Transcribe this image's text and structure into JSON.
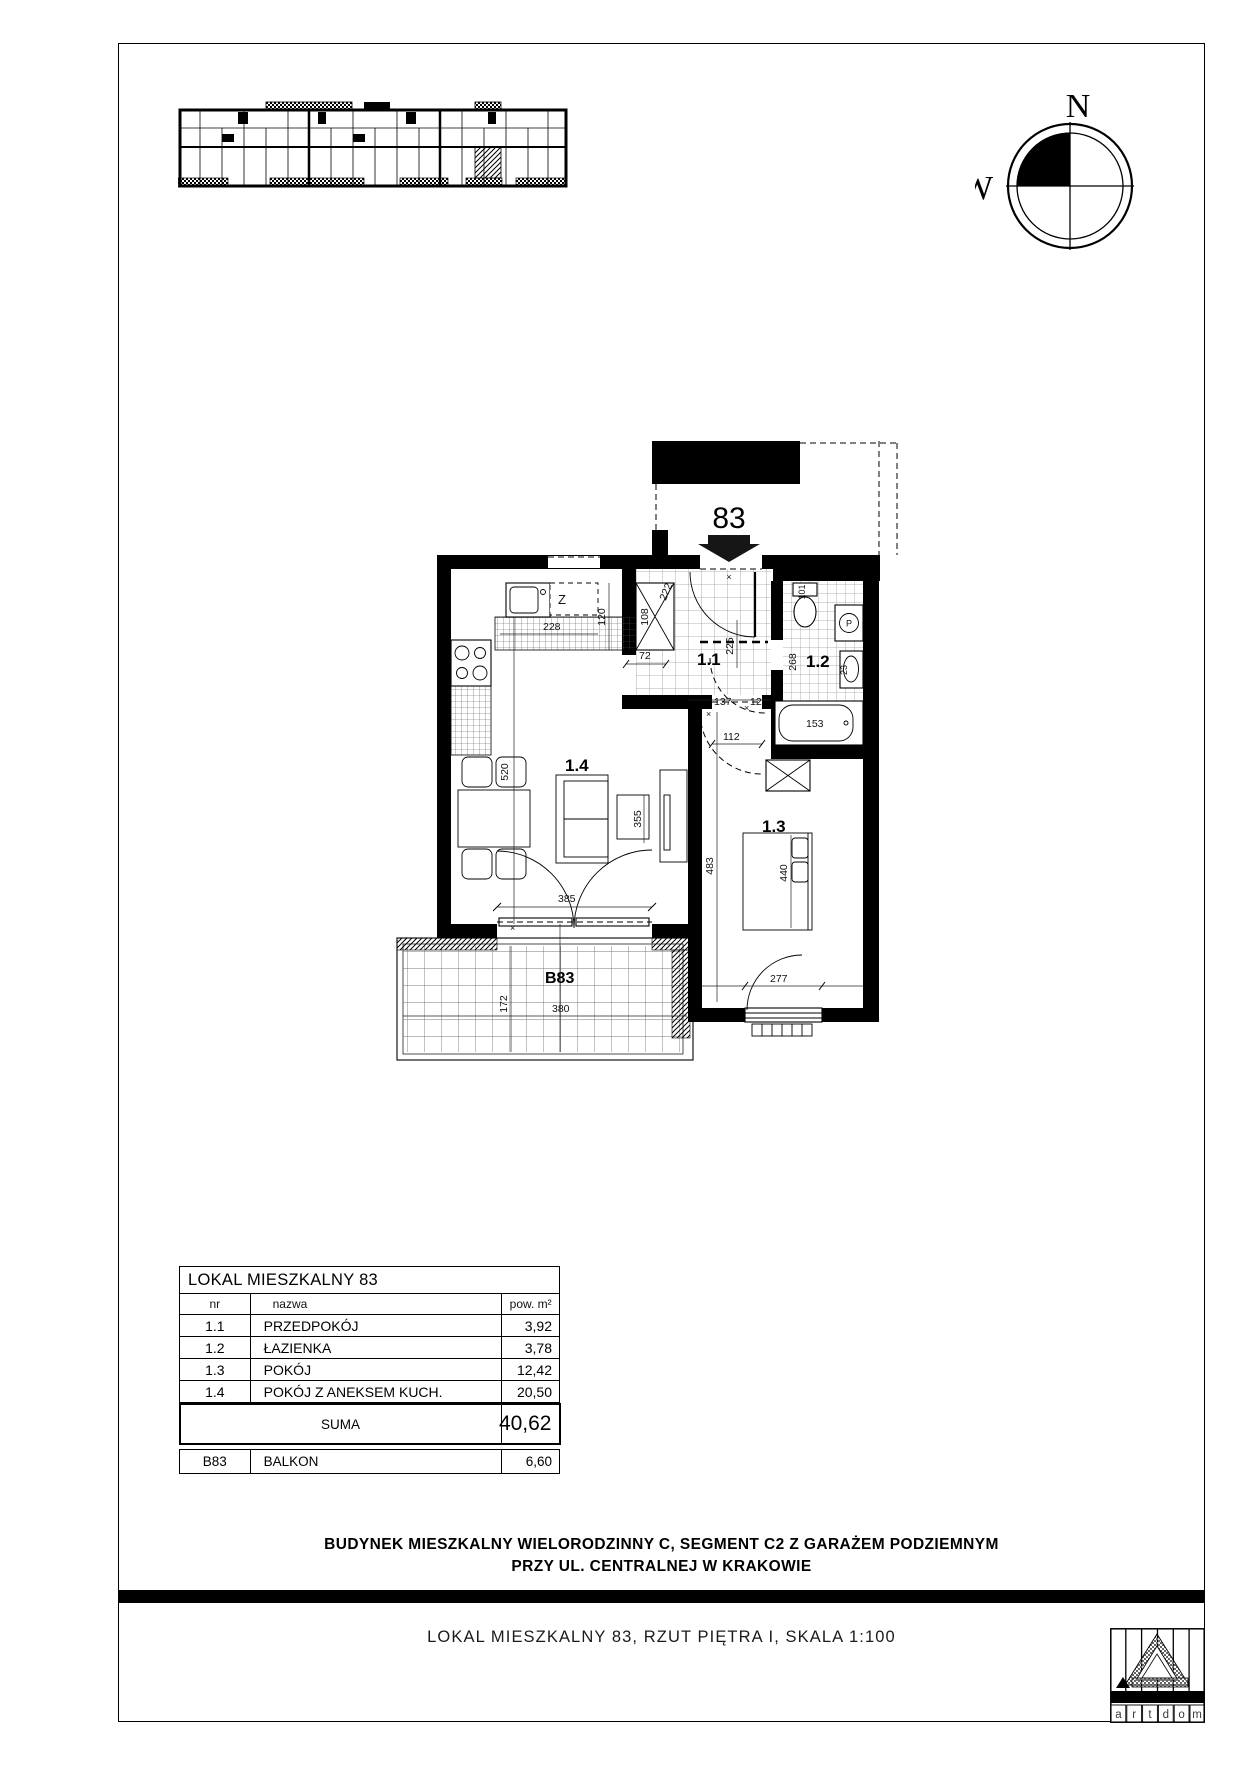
{
  "compass": {
    "north": "N",
    "west": "W"
  },
  "plan": {
    "unit_number": "83",
    "marker": "×",
    "room_labels": {
      "r11": "1.1",
      "r12": "1.2",
      "r13": "1.3",
      "r14": "1.4",
      "balcony": "B83"
    },
    "fixture_labels": {
      "closet": "Z",
      "washer": "P"
    },
    "dims": {
      "counter": "228",
      "fridge": "120",
      "shaft": "108",
      "passage": "72",
      "entry": "222",
      "hall_depth": "225",
      "hall_width": "137",
      "small": "12",
      "door13": "112",
      "bath_door": "268",
      "wc": "101",
      "sink": "23",
      "tub": "153",
      "livingroom": "520",
      "balcony_door": "385",
      "tv_wall": "355",
      "room13_depth": "483",
      "bed": "440",
      "room13_width": "277",
      "balcony_width": "380",
      "balcony_depth": "172"
    }
  },
  "table": {
    "title": "LOKAL MIESZKALNY 83",
    "columns": {
      "nr": "nr",
      "nazwa": "nazwa",
      "pow": "pow. m²"
    },
    "rows": [
      {
        "nr": "1.1",
        "nazwa": "PRZEDPOKÓJ",
        "pow": "3,92"
      },
      {
        "nr": "1.2",
        "nazwa": "ŁAZIENKA",
        "pow": "3,78"
      },
      {
        "nr": "1.3",
        "nazwa": "POKÓJ",
        "pow": "12,42"
      },
      {
        "nr": "1.4",
        "nazwa": "POKÓJ Z ANEKSEM KUCH.",
        "pow": "20,50"
      }
    ],
    "suma_label": "SUMA",
    "suma_value": "40,62",
    "balkon": {
      "nr": "B83",
      "nazwa": "BALKON",
      "pow": "6,60"
    }
  },
  "footer": {
    "line1": "BUDYNEK MIESZKALNY WIELORODZINNY C, SEGMENT C2 Z GARAŻEM PODZIEMNYM",
    "line2": "PRZY UL. CENTRALNEJ W KRAKOWIE",
    "bottom_line": "LOKAL MIESZKALNY 83, RZUT PIĘTRA I, SKALA 1:100"
  },
  "logo": {
    "letters": [
      "a",
      "r",
      "t",
      "d",
      "o",
      "m"
    ]
  }
}
